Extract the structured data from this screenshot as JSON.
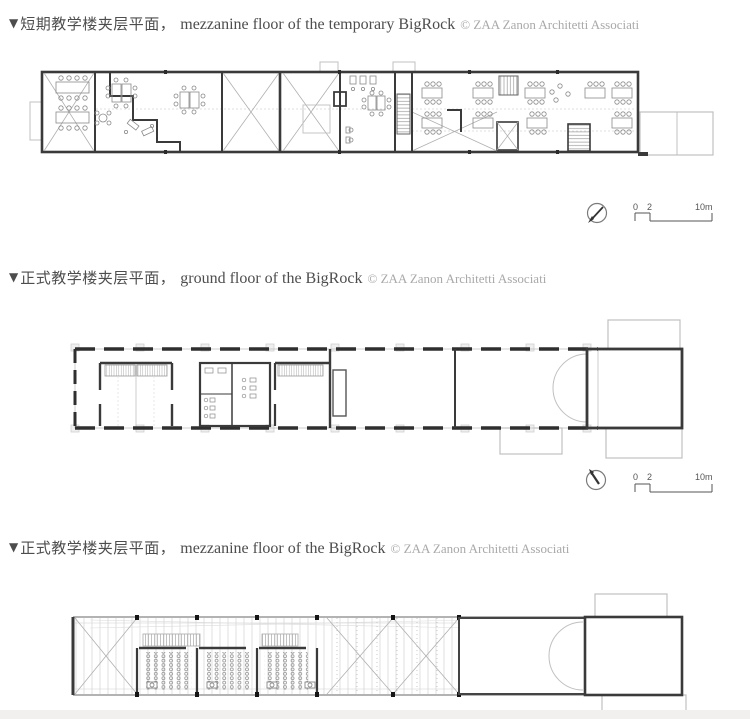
{
  "page": {
    "width": 750,
    "height": 719,
    "background": "#ffffff",
    "footer_strip_color": "#f1f0ee"
  },
  "colors": {
    "caption_text": "#4d4d4d",
    "credit_text": "#a9a9a9",
    "wall_dark": "#3a3a3a",
    "line_medium": "#8a8a8a",
    "line_light": "#c0c0c0"
  },
  "figures": [
    {
      "caption": {
        "marker": "▼",
        "zh": "短期教学楼夹层平面，",
        "en": "mezzanine floor of the temporary BigRock",
        "credit": "© ZAA Zanon Architetti Associati"
      },
      "scalebar": {
        "n0": "0",
        "n2": "2",
        "n10": "10m"
      }
    },
    {
      "caption": {
        "marker": "▼",
        "zh": "正式教学楼夹层平面，",
        "en": "ground floor of the BigRock",
        "credit": "© ZAA Zanon Architetti Associati"
      },
      "scalebar": {
        "n0": "0",
        "n2": "2",
        "n10": "10m"
      }
    },
    {
      "caption": {
        "marker": "▼",
        "zh": "正式教学楼夹层平面，",
        "en": "mezzanine floor of the BigRock",
        "credit": "© ZAA Zanon Architetti Associati"
      }
    }
  ]
}
